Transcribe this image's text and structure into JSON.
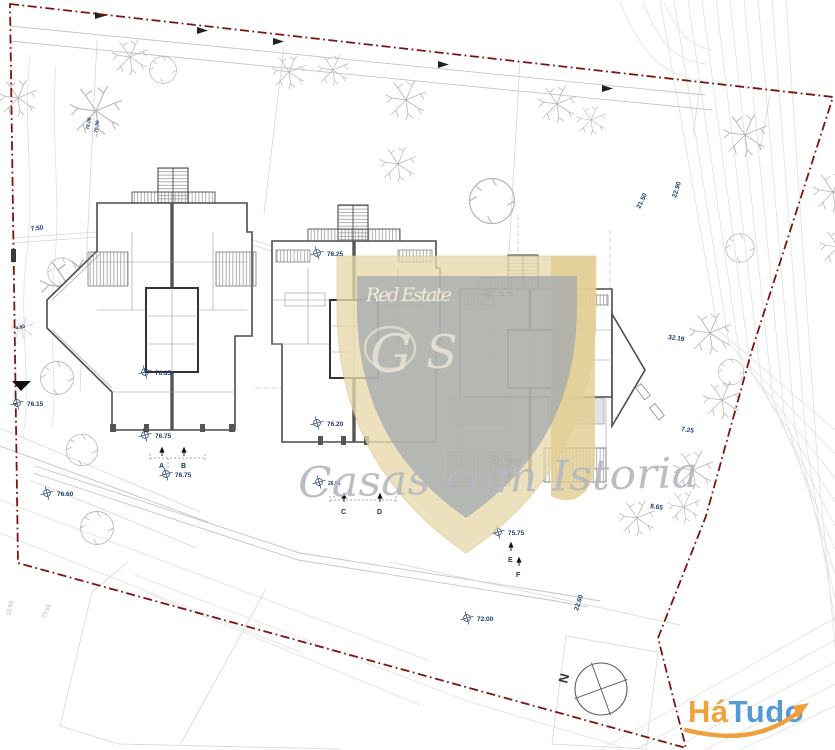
{
  "drawing": {
    "type": "architectural site plan with three semi-detached house floor plans",
    "boundary_color": "#7d140e",
    "label_color": "#1d3a6d"
  },
  "labels": {
    "l750": "7.50",
    "l7806": "78.06",
    "l7690": "76.90",
    "l490": "4.90",
    "l7615": "76.15",
    "l7685": "76.85",
    "l7675a": "76.75",
    "l7675b": "76.75",
    "l7660": "76.60",
    "l7625": "76.25",
    "l7620": "76.20",
    "l2696": "26.96",
    "l7575a": "75.75",
    "l7585": "75.85",
    "l7575b": "75.75",
    "l7200": "72.00",
    "l2260": "22.60",
    "l3219": "32.19",
    "l725": "7.25",
    "l865": "8.65",
    "l2290": "22.90",
    "l2150": "21.50",
    "l7355": "73.55",
    "l1250": "12.50"
  },
  "sections": {
    "a": "A",
    "b": "B",
    "c": "C",
    "d": "D",
    "e": "E",
    "f": "F"
  },
  "watermark": {
    "brand": "Red Estate",
    "monogram_left": "G",
    "monogram_right": "S",
    "tagline": "Casas com Istoria",
    "shield_gold": "#e9d9ab",
    "shield_gray": "#a0a6ae",
    "tagline_color": "#b5b9bf"
  },
  "logo": {
    "ha": "Há",
    "tudo": "Tudo",
    "orange": "#f0a23f",
    "blue": "#549bd5"
  },
  "compass": {
    "north": "N"
  }
}
